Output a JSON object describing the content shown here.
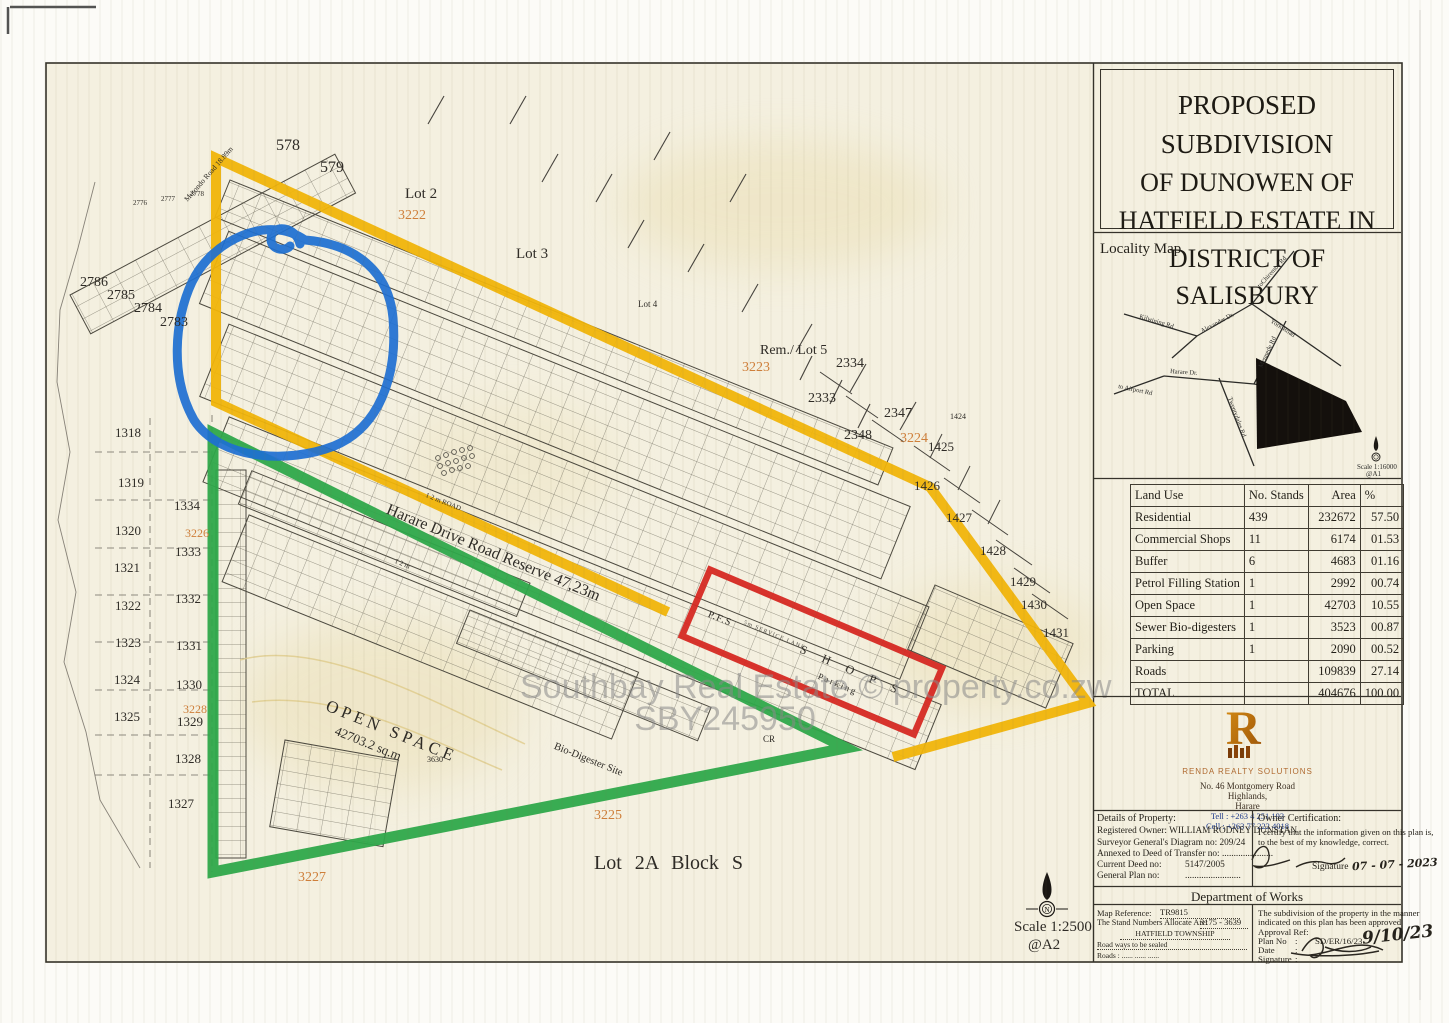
{
  "title_block": {
    "line1": "PROPOSED SUBDIVISION",
    "line2": "OF DUNOWEN OF",
    "line3": "HATFIELD ESTATE IN",
    "line4": "DISTRICT OF SALISBURY"
  },
  "locality": {
    "heading": "Locality Map",
    "scale": "Scale 1:16000",
    "sheet": "@A1",
    "roads": {
      "kilwinning": "Kilwining Rd",
      "alexander": "Alexander Dr.",
      "chiremba": "toChiremba Rd",
      "york": "York  Road",
      "mennede": "Mennede Rd",
      "harare": "Harare Dr.",
      "airport": "to Airport Rd",
      "twentydales": "Twentydales Rd"
    }
  },
  "land_use": {
    "headers": [
      "Land Use",
      "No. Stands",
      "Area",
      "%"
    ],
    "rows": [
      {
        "name": "Residential",
        "stands": "439",
        "area": "232672",
        "pct": "57.50"
      },
      {
        "name": "Commercial Shops",
        "stands": "11",
        "area": "6174",
        "pct": "01.53"
      },
      {
        "name": "Buffer",
        "stands": "6",
        "area": "4683",
        "pct": "01.16"
      },
      {
        "name": "Petrol Filling Station",
        "stands": "1",
        "area": "2992",
        "pct": "00.74"
      },
      {
        "name": "Open Space",
        "stands": "1",
        "area": "42703",
        "pct": "10.55"
      },
      {
        "name": "Sewer Bio-digesters",
        "stands": "1",
        "area": "3523",
        "pct": "00.87"
      },
      {
        "name": "Parking",
        "stands": "1",
        "area": "2090",
        "pct": "00.52"
      },
      {
        "name": "Roads",
        "stands": "",
        "area": "109839",
        "pct": "27.14"
      },
      {
        "name": "TOTAL",
        "stands": "",
        "area": "404676",
        "pct": "100.00"
      }
    ]
  },
  "logo": {
    "monogram": "R",
    "company": "RENDA REALTY SOLUTIONS",
    "addr1": "No. 46 Montgomery Road",
    "addr2": "Highlands,",
    "addr3": "Harare",
    "tel": "Tell    : +263 4 251 193",
    "cell": "Cell    : +263 77 222 4018"
  },
  "details": {
    "heading": "Details of Property:",
    "owner": "Registered Owner: WILLIAM RODNEY DUNSTAN",
    "sg": "Surveyor General's Diagram no:   209/24",
    "annexed": "Annexed to  Deed of Transfer no: ......................",
    "deed_label": "Current Deed no:",
    "deed": "5147/2005",
    "gp_label": "General Plan no:",
    "gp": "........................"
  },
  "owner_cert": {
    "heading": "Owner Certification:",
    "body1": "I certify that the information given on this plan is,",
    "body2": "to the best of my knowledge, correct.",
    "sig_label": "Signature",
    "date": "07 - 07 - 2023"
  },
  "works": {
    "heading": "Department of Works",
    "map_ref_label": "Map Reference:",
    "map_ref": "TR9815",
    "stands_label": "The Stand Numbers Allocate Are:",
    "stands": "3175   -   3639",
    "township": "HATFIELD TOWNSHIP",
    "note1": "Road ways to be sealed",
    "note2": "Roads :        ......        ......        ......",
    "approved1": "The subdivision of the property in the manner",
    "approved2": "indicated on  this plan has been approved",
    "approval_ref": "Approval Ref:",
    "plan_no_label": "Plan No",
    "plan_no": "SD/ER/16/23",
    "plan_no_hand": "9/10/23",
    "date_label": "Date",
    "sig_label": "Signature",
    "colon": ":"
  },
  "map": {
    "watermark1": "Southbay Real Estate  ©  property.co.zw",
    "watermark2": "SBY245950",
    "scale": "Scale 1:2500",
    "sheet": "@A2",
    "north": "N",
    "labels": {
      "n578": "578",
      "n579": "579",
      "lot2": "Lot 2",
      "lot3": "Lot 3",
      "lot4": "Lot 4",
      "rem_lot5": "Rem./ Lot 5",
      "o3222": "3222",
      "o3223": "3223",
      "o3224": "3224",
      "o3225": "3225",
      "o3226": "3226",
      "o3227": "3227",
      "o3228": "3228",
      "n2334": "2334",
      "n2333": "2333",
      "n2347": "2347",
      "n2348": "2348",
      "n1424": "1424",
      "n1425": "1425",
      "n1426": "1426",
      "n1427": "1427",
      "n1428": "1428",
      "n1429": "1429",
      "n1430": "1430",
      "n1431": "1431",
      "n2786": "2786",
      "n2785": "2785",
      "n2784": "2784",
      "n2783": "2783",
      "n2778": "2778",
      "n2777": "2777",
      "n2776": "2776",
      "n1318": "1318",
      "n1319": "1319",
      "n1320": "1320",
      "n1321": "1321",
      "n1322": "1322",
      "n1323": "1323",
      "n1324": "1324",
      "n1325": "1325",
      "n1327": "1327",
      "n1328": "1328",
      "n1329": "1329",
      "n1330": "1330",
      "n1331": "1331",
      "n1332": "1332",
      "n1333": "1333",
      "n1334": "1334",
      "open_space": "OPEN SPACE",
      "open_space_area": "42703.2 sq.m",
      "n3630": "3630",
      "bio": "Bio-Digester Site",
      "harare": "Harare Drive Road  Reserve     47,23m",
      "road12a": "1 2 m ROAD",
      "road12b": "1 2 m",
      "lot2a": "Lot 2A  Block   S",
      "cr": "CR",
      "pfs": "P.F.S",
      "shops": "S H O P S",
      "parking": "Parking",
      "lane": "5m  SERVICE  LANE",
      "mutondo": "Mutondo   Road 18.89m"
    }
  }
}
